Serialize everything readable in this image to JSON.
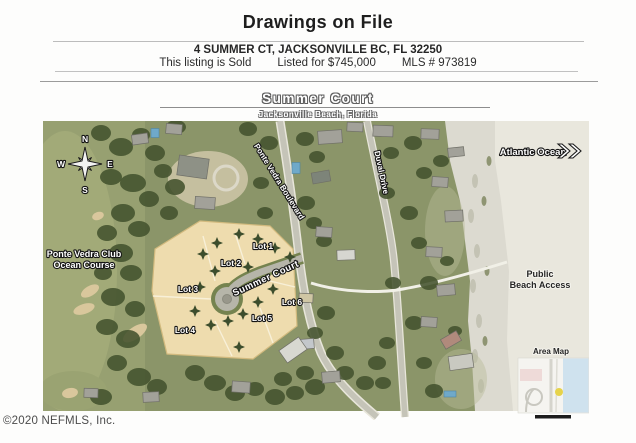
{
  "header": {
    "title": "Drawings on File",
    "address": "4 SUMMER CT, JACKSONVILLE BC, FL 32250",
    "status": "This listing is Sold",
    "price": "Listed for $745,000",
    "mls": "MLS # 973819"
  },
  "map": {
    "title": "Summer Court",
    "subtitle": "Jacksonville Beach, Florida",
    "compass": {
      "n": "N",
      "e": "E",
      "s": "S",
      "w": "W"
    },
    "labels": {
      "golf_line1": "Ponte Vedra Club",
      "golf_line2": "Ocean Course",
      "atlantic_ocean": "Atlantic Ocean",
      "ponte_vedra_blvd": "Ponte Vedra Boulevard",
      "duval_drive": "Duval Drive",
      "summer_court_road": "Summer Court",
      "public_line1": "Public",
      "public_line2": "Beach Access",
      "area_map": "Area Map"
    },
    "lots": [
      "Lot 1",
      "Lot 2",
      "Lot 3",
      "Lot 4",
      "Lot 5",
      "Lot 6"
    ]
  },
  "footer": {
    "copyright": "©2020 NEFMLS, Inc."
  },
  "colors": {
    "parcel_tan": "#eedcae",
    "vegetation_green": "#8b9569",
    "beach_sand": "#dcdad0",
    "marker_yellow": "#e6d34b"
  }
}
